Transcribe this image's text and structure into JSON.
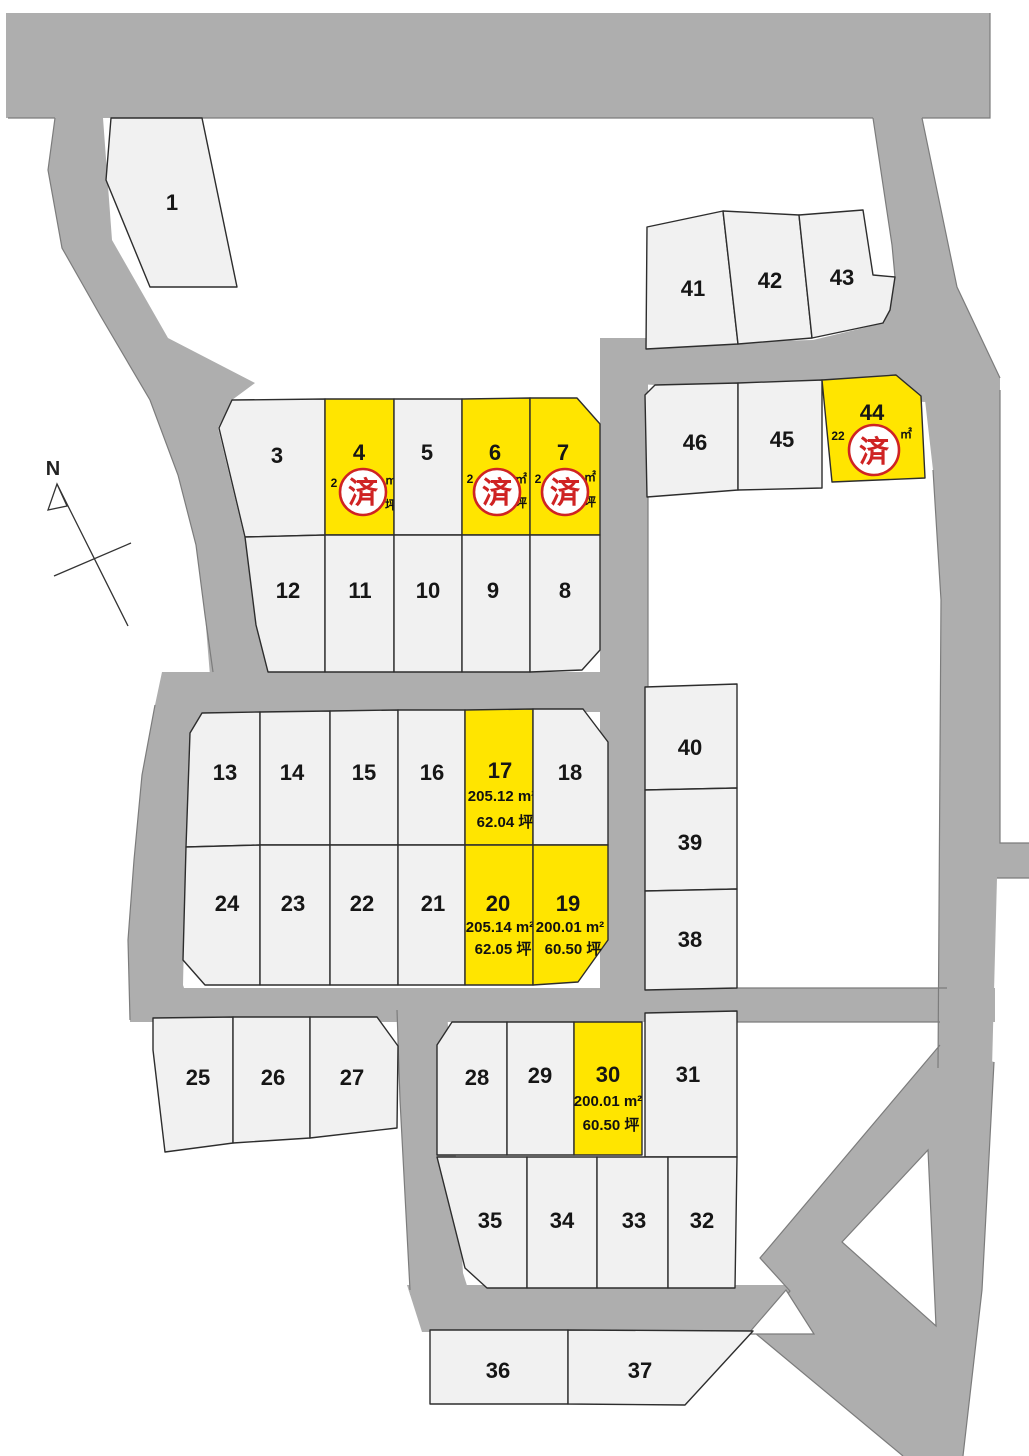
{
  "compass": {
    "label": "N"
  },
  "sold_stamp_label": "済",
  "map_colors": {
    "highlight_yellow": "#ffe500",
    "stamp_red": "#cf2323",
    "road_gray": "#aeaeae",
    "lot_fill": "#f1f1f1"
  },
  "lots": {
    "1": {
      "number": "1"
    },
    "3": {
      "number": "3"
    },
    "4": {
      "number": "4",
      "status": "sold",
      "fragments": {
        "left": "2",
        "unit": "㎡",
        "tsubo": "坪"
      }
    },
    "5": {
      "number": "5"
    },
    "6": {
      "number": "6",
      "status": "sold",
      "fragments": {
        "left": "2",
        "unit": "㎡",
        "tsubo": "坪"
      }
    },
    "7": {
      "number": "7",
      "status": "sold",
      "fragments": {
        "left": "2",
        "unit": "㎡",
        "tsubo": "坪"
      }
    },
    "8": {
      "number": "8"
    },
    "9": {
      "number": "9"
    },
    "10": {
      "number": "10"
    },
    "11": {
      "number": "11"
    },
    "12": {
      "number": "12"
    },
    "13": {
      "number": "13"
    },
    "14": {
      "number": "14"
    },
    "15": {
      "number": "15"
    },
    "16": {
      "number": "16"
    },
    "17": {
      "number": "17",
      "highlighted": true,
      "area": "205.12 m²",
      "tsubo": "62.04 坪"
    },
    "18": {
      "number": "18"
    },
    "19": {
      "number": "19",
      "highlighted": true,
      "area": "200.01 m²",
      "tsubo": "60.50 坪"
    },
    "20": {
      "number": "20",
      "highlighted": true,
      "area": "205.14 m²",
      "tsubo": "62.05 坪"
    },
    "21": {
      "number": "21"
    },
    "22": {
      "number": "22"
    },
    "23": {
      "number": "23"
    },
    "24": {
      "number": "24"
    },
    "25": {
      "number": "25"
    },
    "26": {
      "number": "26"
    },
    "27": {
      "number": "27"
    },
    "28": {
      "number": "28"
    },
    "29": {
      "number": "29"
    },
    "30": {
      "number": "30",
      "highlighted": true,
      "area": "200.01 m²",
      "tsubo": "60.50 坪"
    },
    "31": {
      "number": "31"
    },
    "32": {
      "number": "32"
    },
    "33": {
      "number": "33"
    },
    "34": {
      "number": "34"
    },
    "35": {
      "number": "35"
    },
    "36": {
      "number": "36"
    },
    "37": {
      "number": "37"
    },
    "38": {
      "number": "38"
    },
    "39": {
      "number": "39"
    },
    "40": {
      "number": "40"
    },
    "41": {
      "number": "41"
    },
    "42": {
      "number": "42"
    },
    "43": {
      "number": "43"
    },
    "44": {
      "number": "44",
      "status": "sold",
      "fragments": {
        "left": "22",
        "unit": "㎡"
      }
    },
    "45": {
      "number": "45"
    },
    "46": {
      "number": "46"
    }
  }
}
